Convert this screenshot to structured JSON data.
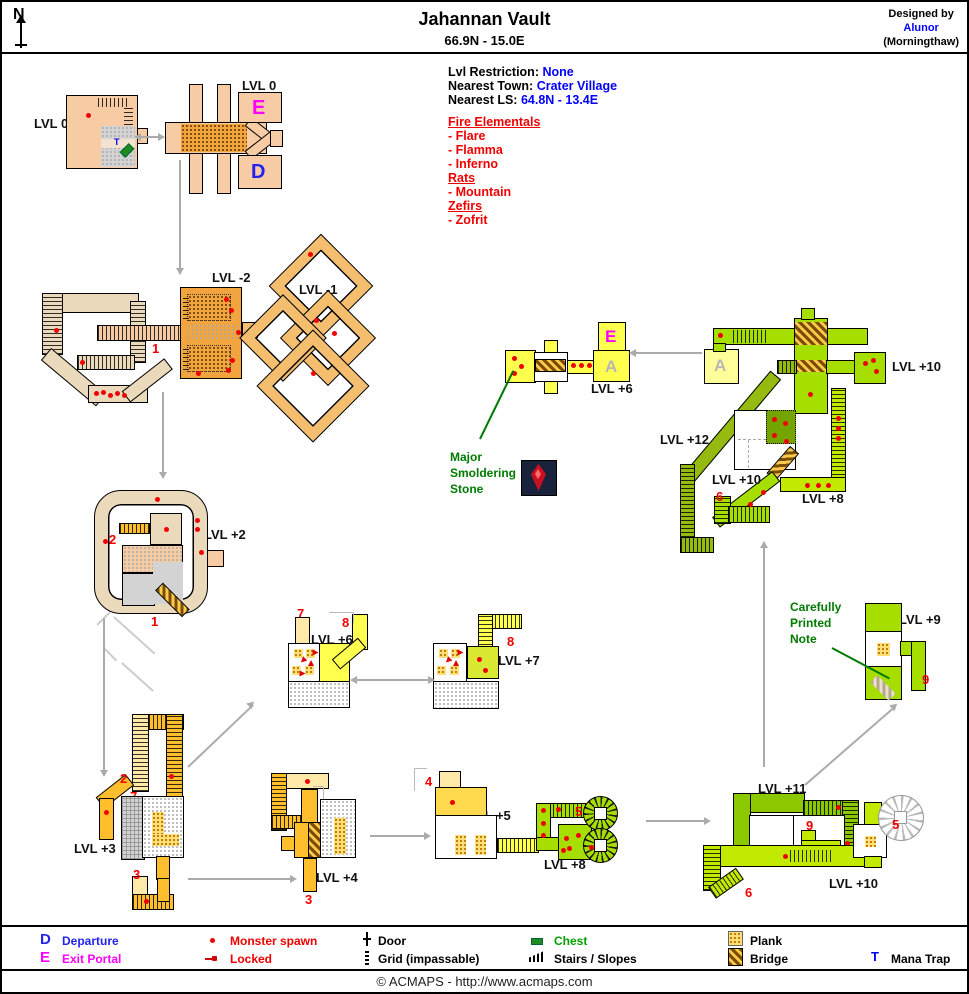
{
  "header": {
    "compass": "N",
    "title": "Jahannan Vault",
    "subtitle": "66.9N - 15.0E",
    "designed_by": "Designed by",
    "designer": "Alunor",
    "designer_world": "(Morningthaw)"
  },
  "info": {
    "restriction_label": "Lvl Restriction:",
    "restriction_value": "None",
    "town_label": "Nearest Town:",
    "town_value": "Crater Village",
    "ls_label": "Nearest LS:",
    "ls_value": "64.8N - 13.4E"
  },
  "monsters": {
    "groups": [
      {
        "name": "Fire Elementals",
        "items": [
          "- Flare",
          "- Flamma",
          "- Inferno"
        ]
      },
      {
        "name": "Rats",
        "items": [
          "- Mountain"
        ]
      },
      {
        "name": "Zefirs",
        "items": [
          "- Zofrit"
        ]
      }
    ]
  },
  "annotations": {
    "stone": "Major Smoldering Stone",
    "note": "Carefully Printed Note"
  },
  "maps": {
    "entry": {
      "label": "LVL 0"
    },
    "hub": {
      "label": "LVL 0"
    },
    "m2": {
      "label": "LVL -2"
    },
    "m1": {
      "label": "LVL -1"
    },
    "p2": {
      "label": "LVL +2"
    },
    "p3": {
      "label": "LVL +3"
    },
    "p4": {
      "label": "LVL +4"
    },
    "p5": {
      "label": "LVL +5"
    },
    "p6mid": {
      "label": "LVL +6"
    },
    "p7": {
      "label": "LVL +7"
    },
    "p8low": {
      "label": "LVL +8"
    },
    "p6exit": {
      "label": "LVL +6"
    },
    "p9": {
      "label": "LVL +9"
    },
    "p10right": {
      "label": "LVL +10"
    },
    "p10mid": {
      "label": "LVL +10"
    },
    "p8right": {
      "label": "LVL +8"
    },
    "p12": {
      "label": "LVL +12"
    },
    "p11": {
      "label": "LVL +11"
    },
    "p10bottom": {
      "label": "LVL +10"
    }
  },
  "map_numbers": {
    "1": "1",
    "2": "2",
    "3": "3",
    "4": "4",
    "5": "5",
    "6": "6",
    "7": "7",
    "8": "8",
    "9": "9"
  },
  "letters": {
    "departure": "D",
    "exit": "E",
    "link": "A",
    "mana_trap": "T"
  },
  "legend": {
    "departure": "Departure",
    "exit_portal": "Exit Portal",
    "monster_spawn": "Monster spawn",
    "locked": "Locked",
    "door": "Door",
    "grid": "Grid (impassable)",
    "chest": "Chest",
    "stairs": "Stairs / Slopes",
    "plank": "Plank",
    "bridge": "Bridge",
    "mana_trap": "Mana Trap"
  },
  "footer": "© ACMAPS - http://www.acmaps.com",
  "colors": {
    "blue": "#0000FF",
    "red": "#FF0000",
    "magenta": "#FF00FF",
    "green_text": "#007A00",
    "map_green": "#A6DE00",
    "map_yellow": "#FFFF4F",
    "map_orange": "#F2A43E",
    "map_peach": "#F7CBA3",
    "map_gold": "#FFBE2E",
    "map_tan": "#EBD9BC",
    "arrow_gray": "#ABABAB"
  }
}
